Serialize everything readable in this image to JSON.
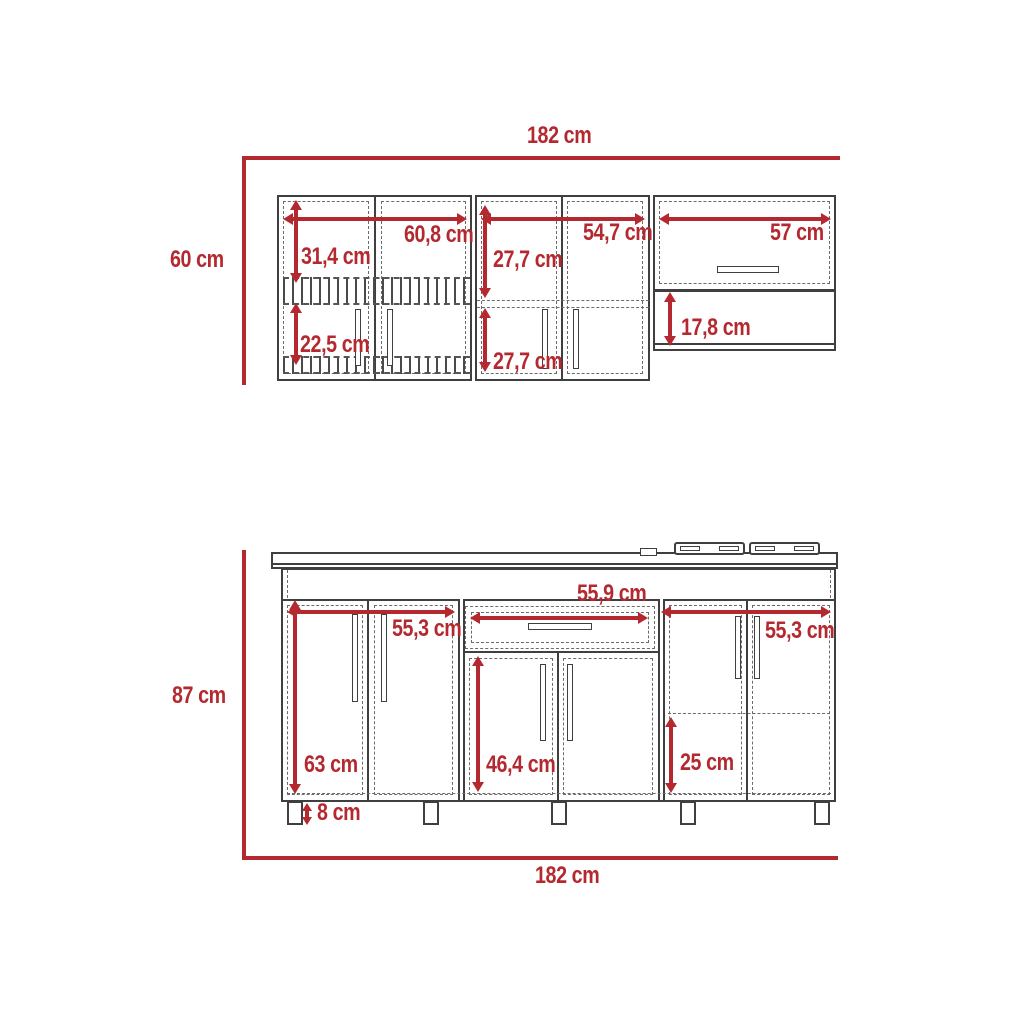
{
  "diagram_title": "kitchen-cabinet-dimension-drawing",
  "colors": {
    "accent": "#b4292f",
    "line": "#3f3f3f",
    "dash": "#6b6b6b",
    "background": "#ffffff"
  },
  "upper_section": {
    "name": "wall-cabinet",
    "total_width": "182 cm",
    "total_height": "60 cm",
    "dims": {
      "left_width": "60,8 cm",
      "left_top_height": "31,4 cm",
      "left_bottom_height": "22,5 cm",
      "mid_top_height": "27,7 cm",
      "mid_width": "54,7 cm",
      "mid_bottom_height": "27,7 cm",
      "right_width": "57 cm",
      "right_shelf_height": "17,8 cm"
    }
  },
  "lower_section": {
    "name": "base-cabinet",
    "total_width": "182 cm",
    "total_height": "87 cm",
    "dims": {
      "drawer_width": "55,9 cm",
      "left_width": "55,3 cm",
      "right_width": "55,3 cm",
      "left_height": "63 cm",
      "mid_door_height": "46,4 cm",
      "right_shelf_height": "25 cm",
      "leg_height": "8 cm"
    }
  }
}
